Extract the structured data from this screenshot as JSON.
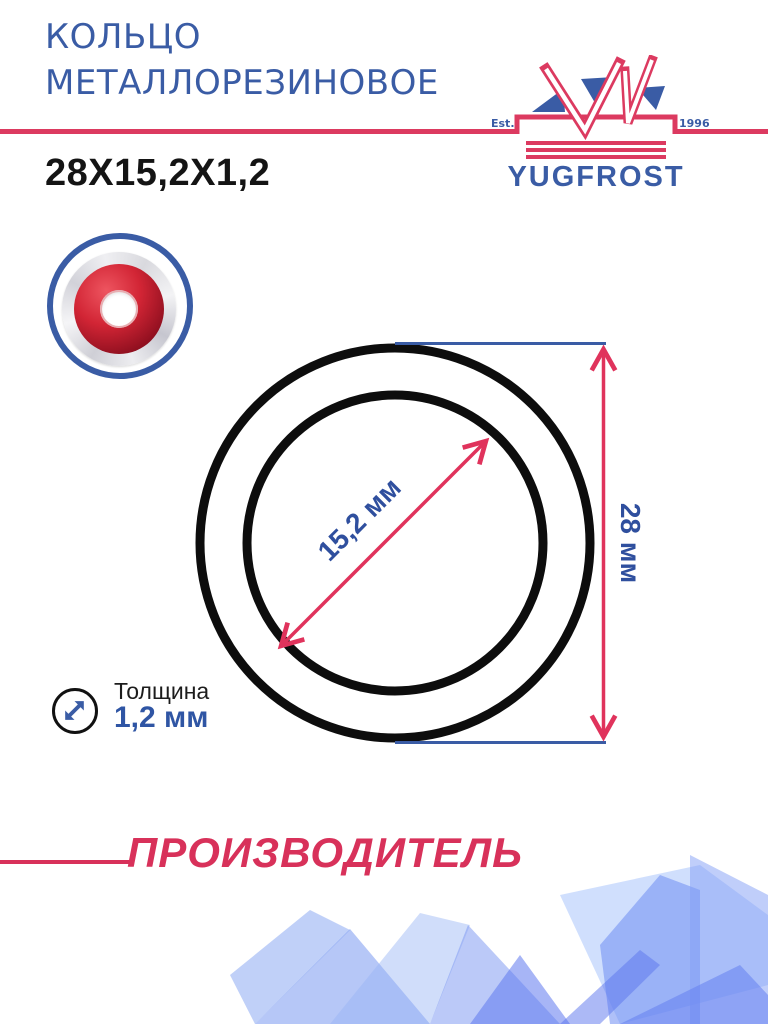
{
  "header": {
    "title_line1": "КОЛЬЦО",
    "title_line2": "МЕТАЛЛОРЕЗИНОВОЕ",
    "size_code": "28X15,2X1,2"
  },
  "logo": {
    "est": "Est.",
    "year": "1996",
    "brand": "YUGFROST"
  },
  "drawing": {
    "inner_diameter": "15,2 мм",
    "outer_diameter": "28 мм"
  },
  "thickness": {
    "label": "Толщина",
    "value": "1,2 мм"
  },
  "footer": {
    "manufacturer": "ПРОИЗВОДИТЕЛЬ"
  },
  "icons": {
    "thickness_icon": "diagonal-double-arrow",
    "product_thumb": "metal-rubber-ring-photo",
    "logo_emblem": "yugfrost-double-v-emblem"
  },
  "colors": {
    "brand_blue": "#3a5ca5",
    "accent_red": "#dc3a60",
    "label_blue": "#2f4f9e",
    "drawing_black": "#0d0d0d",
    "decor_blue": "#7d9cf0"
  }
}
